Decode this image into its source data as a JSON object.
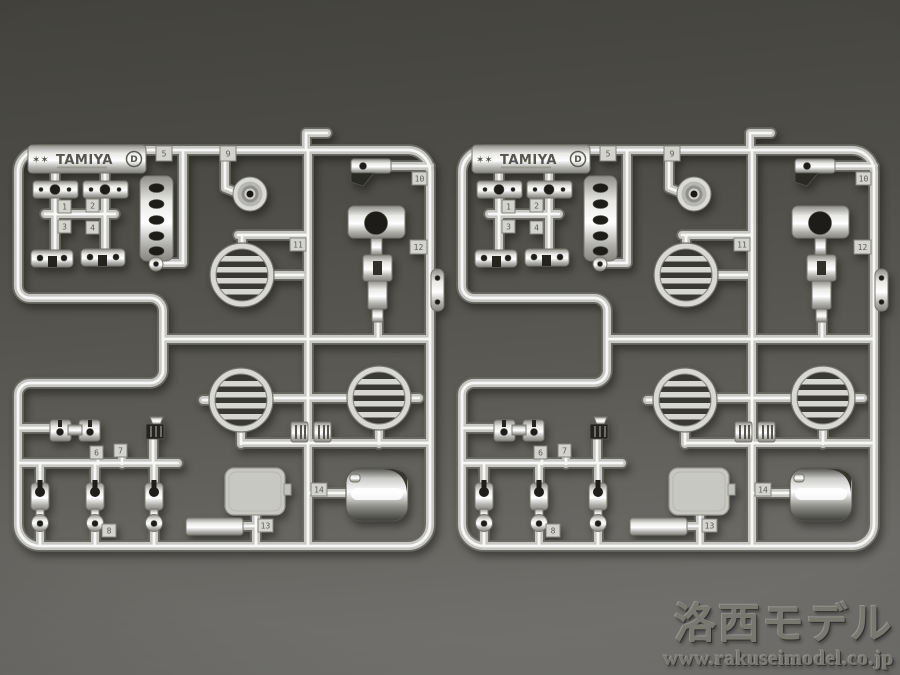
{
  "sprue": {
    "logo": {
      "mark": "✶✶",
      "brand": "TAMIYA",
      "letter": "D"
    },
    "tags": {
      "t1": "1",
      "t2": "2",
      "t3": "3",
      "t4": "4",
      "t5": "5",
      "t6": "6",
      "t7": "7",
      "t8": "8",
      "t9": "9",
      "t10": "10",
      "t11": "11",
      "t12": "12",
      "t13": "13",
      "t14": "14"
    }
  },
  "watermark": {
    "shop_name": "洛西モデル",
    "website": "www.rakuseimodel.co.jp"
  },
  "colors": {
    "background_top": "#43423d",
    "background_bottom": "#747370",
    "chrome_highlight": "#f7f7f5",
    "chrome_shadow": "#6b6a65"
  }
}
